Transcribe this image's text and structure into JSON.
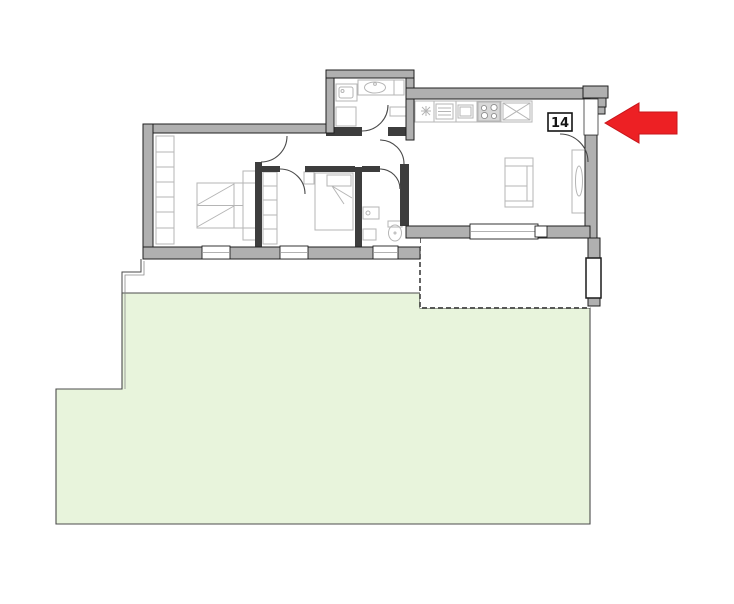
{
  "image_type": "apartment-floor-plan-with-garden",
  "unit": {
    "label": "14"
  },
  "arrow": {
    "direction": "left",
    "shape": "solid-block-arrow"
  },
  "colors": {
    "background": "#ffffff",
    "wall_fill": "#b0b0b0",
    "wall_stroke": "#1f1f1f",
    "interior_wall": "#3d3d3d",
    "furniture": "#b5b5b5",
    "door_arc": "#4a4a4a",
    "garden_fill": "#e8f4dc",
    "garden_stroke": "#4c4c4c",
    "terrace_dash": "#232323",
    "arrow_fill": "#ed2024",
    "label_color": "#141414"
  },
  "fixtures": [
    "wardrobe",
    "double-bed",
    "nightstand",
    "single-bed",
    "washbasin",
    "toilet",
    "washing-machine",
    "bathroom-counter",
    "kitchen-counter",
    "fridge",
    "stove",
    "kitchen-sink",
    "sofa",
    "radiator",
    "planter",
    "entrance-steps"
  ]
}
